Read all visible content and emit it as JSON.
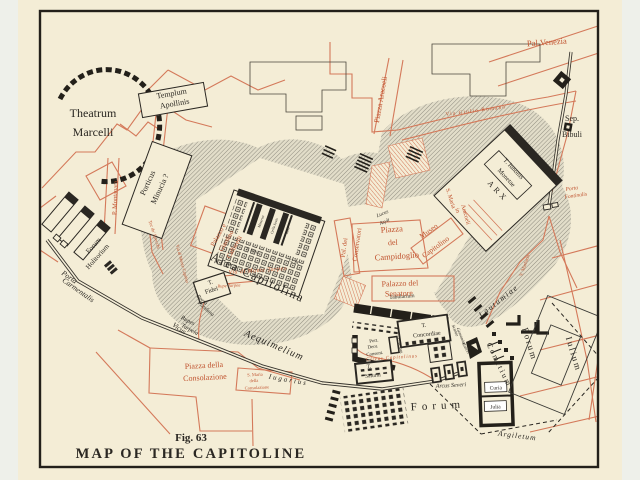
{
  "figure": {
    "number": "Fig. 63",
    "title": "MAP OF THE CAPITOLINE"
  },
  "colors": {
    "paper": "#f4edd6",
    "ink": "#2a2722",
    "street_red": "#d4795a",
    "label_red": "#c0532f",
    "hill_gray": "#8f8c7f"
  },
  "labels": {
    "theatrum1": "Theatrum",
    "theatrum2": "Marcelli",
    "templum1": "Templum",
    "templum2": "Apollinis",
    "porticus1": "Porticus",
    "porticus2": "Minucia ?",
    "forumhol1": "Forum",
    "forumhol2": "Holitorium",
    "portacarm1": "Porta",
    "portacarm2": "Carmentalis",
    "montanara": "P. Montanara",
    "torspecchi": "Tor de' Specchi",
    "montecaprino": "Via di Monte Caprino",
    "palvenezia": "Pal.Venezia",
    "piazzaaracoeli": "Piazza Aracoeli",
    "viagiulio": "Via Giulio Romano",
    "sep1": "Sep.",
    "sep2": "Bibuli",
    "portafont1": "Porta",
    "portafont2": "Fontinalis",
    "iunonis1": "T. Iunonis",
    "iunonis2": "Monetae",
    "arx": "ARX",
    "smaria1": "S. Maria",
    "smaria2": "in",
    "smaria3": "Aracoeli",
    "museo1": "Museo",
    "museo2": "Capitolino",
    "pcamp1": "Piazza",
    "pcamp2": "del",
    "pcamp3": "Campidoglio",
    "conserv1": "Pal. dei",
    "conserv2": "Conservatori",
    "senatore1": "Palazzo del",
    "senatore2": "Senatore",
    "tabularium": "Tabularium",
    "caffarelli1": "Palazzo e",
    "caffarelli2": "Giardino",
    "caffarelli3": "Caffarelli",
    "areacap": "Area Capitolina",
    "viamontetarpeo": "Via di Monte Tarpeo",
    "rupetarpea": "Rupe Tarpea",
    "fidei1": "T.",
    "fidei2": "Fidei",
    "portapand1": "Porta",
    "portapand2": "Pandana",
    "rupes1": "Rupes",
    "rupes2": "Tarpeia",
    "minerva": "Minerva",
    "cellaiovis": "Cella Iovis",
    "iuno": "Iuno",
    "tiovis": "T. Iovis",
    "om": "O. M.",
    "lucus1": "Lucus",
    "lucus2": "Asyli",
    "aequimelium": "Aequimelium",
    "vicus": "Vicus",
    "iugarius": "Iugarius",
    "piazzacons1": "Piazza della",
    "piazzacons2": "Consolazione",
    "smcons1": "S. Maria",
    "smcons2": "della",
    "smcons3": "Consolazione",
    "clivuscap": "Clivus Capitolinus",
    "concordiae1": "T.",
    "concordiae2": "Concordiae",
    "portdeor1": "Port.",
    "portdeor2": "Deor.",
    "portdeor3": "Consent.",
    "tsaturni1": "T.",
    "tsaturni2": "Saturni",
    "tvespas": "T. Vespas.",
    "arcusseveri": "Arcus Severi",
    "forummain": "Forum",
    "scalae1": "Scalae",
    "scalae2": "Gemoniae",
    "carcer": "Carcer",
    "lautumiae": "Lautumiae",
    "comitium": "Comitium",
    "forumiul1": "Forum",
    "forumiul2": "Iulium",
    "curia": "Curia",
    "julia": "Julia",
    "argiletum": "Argiletum",
    "marforio": "V. Marforio",
    "figno": "Fig. 63",
    "title": "MAP OF THE CAPITOLINE"
  }
}
